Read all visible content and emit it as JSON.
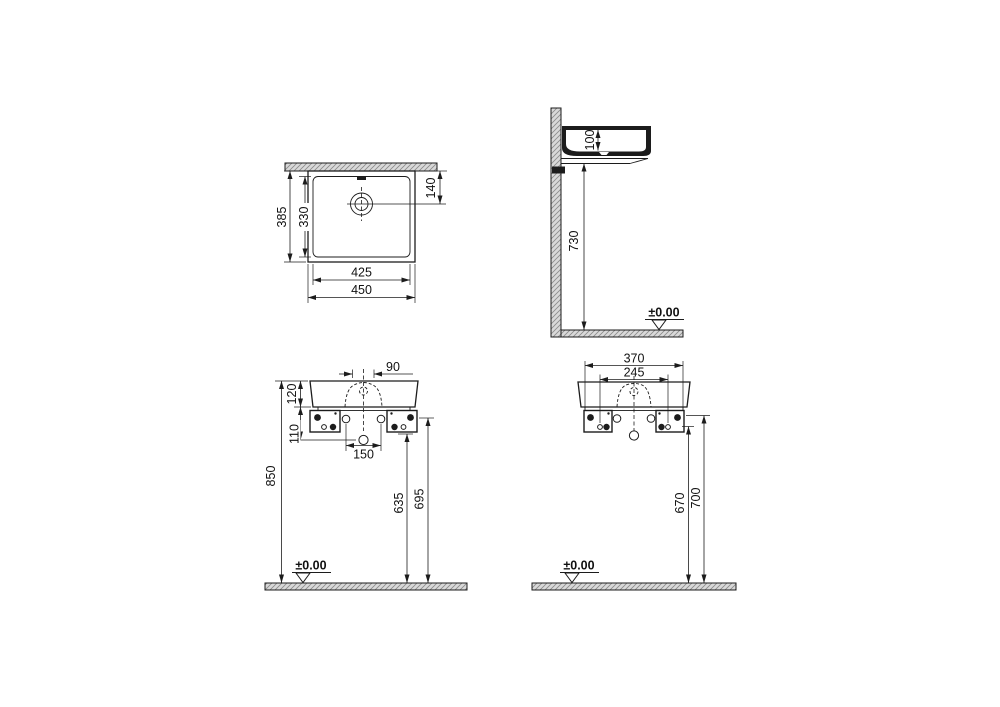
{
  "colors": {
    "line": "#1c1c1c",
    "hatch_fill": "#dcdcdc"
  },
  "views": {
    "plan": {
      "outer_width": "450",
      "inner_width": "425",
      "outer_depth": "385",
      "inner_depth": "330",
      "drain_to_wall": "140"
    },
    "side": {
      "basin_depth": "100",
      "height_under_rim": "730",
      "floor_datum": "±0.00"
    },
    "front": {
      "top_offset": "90",
      "body_height": "120",
      "drain_offset": "110",
      "hole_spacing": "150",
      "overall_height": "850",
      "fixing_height_low": "635",
      "fixing_height_high": "695",
      "floor_datum": "±0.00"
    },
    "rear": {
      "bracket_span": "370",
      "fixing_hole_span": "245",
      "fixing_height_low": "670",
      "fixing_height_high": "700",
      "floor_datum": "±0.00"
    }
  }
}
